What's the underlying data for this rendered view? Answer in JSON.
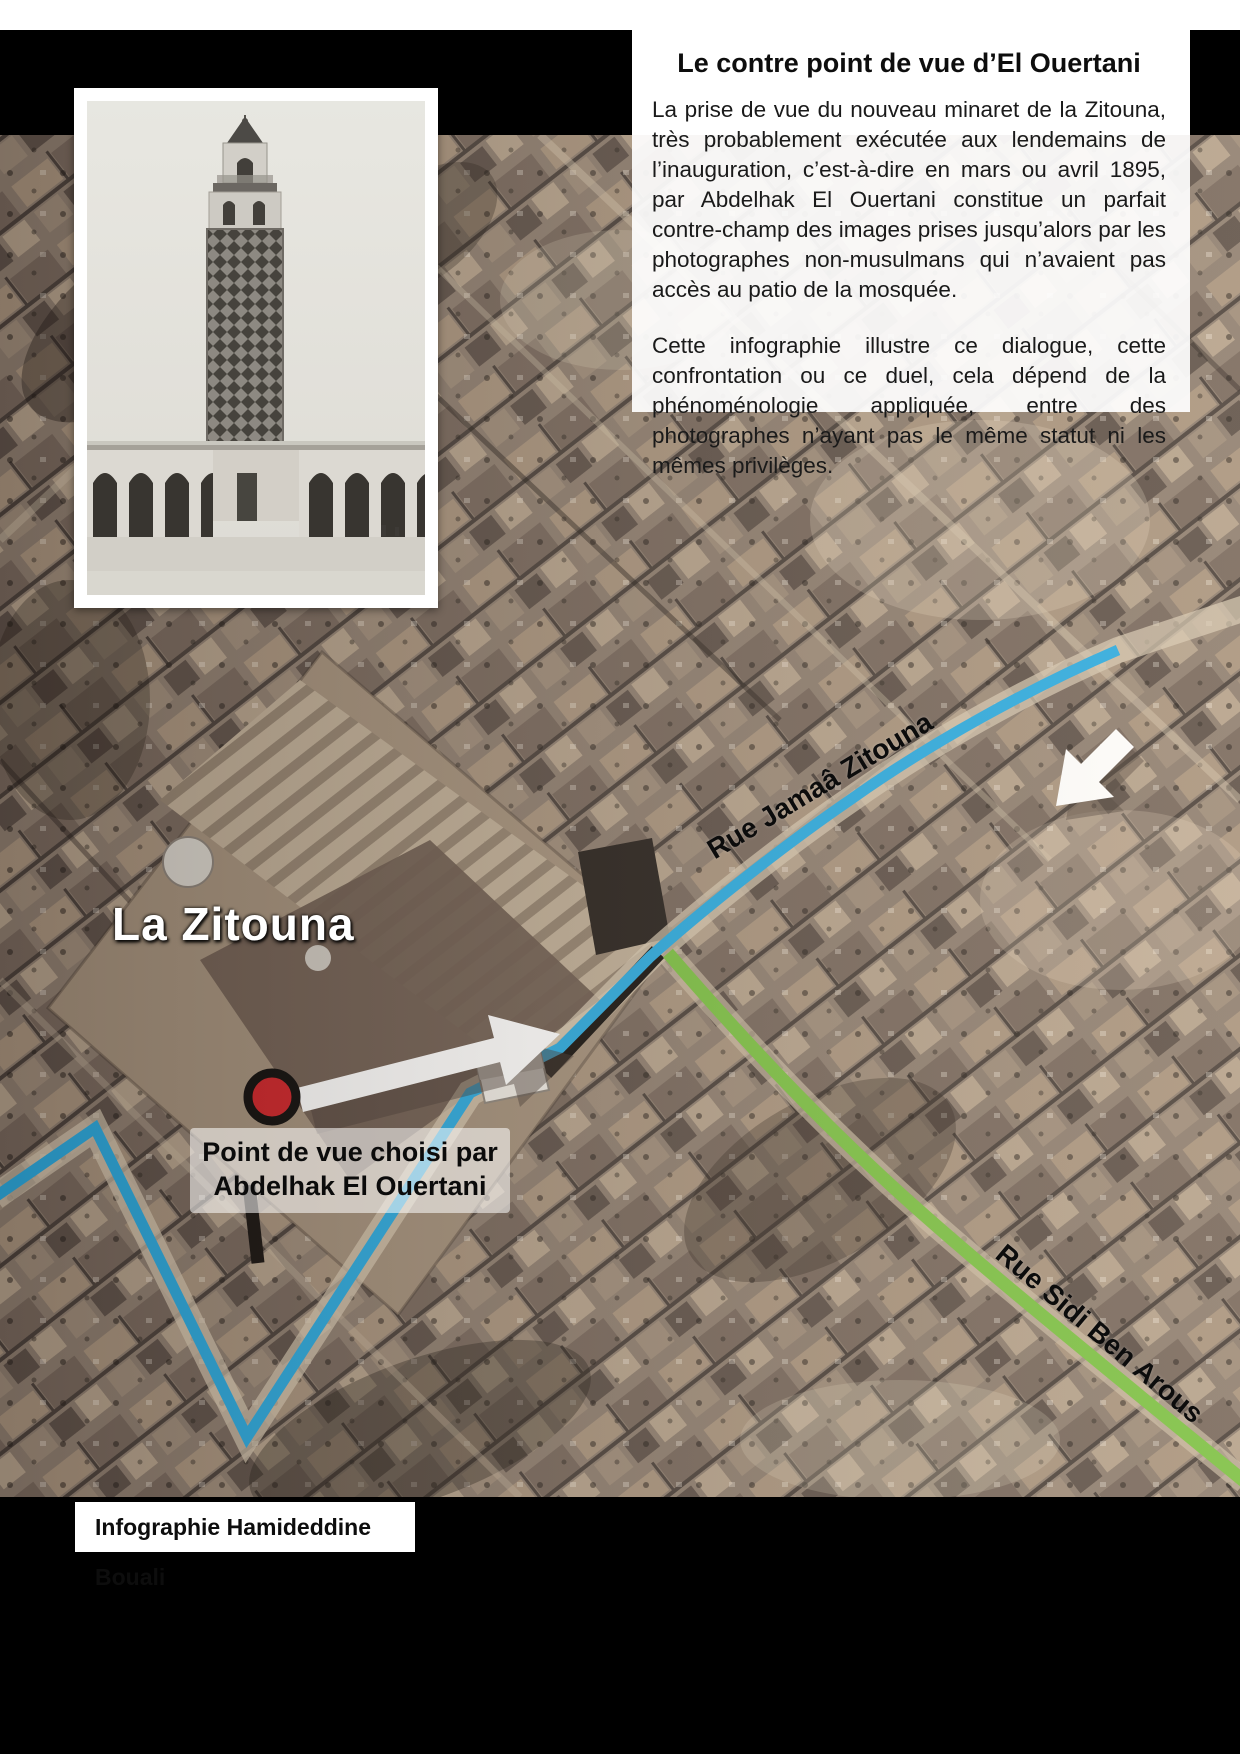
{
  "header_box": {
    "title": "Le contre point de vue d’El Ouertani",
    "paragraphs": [
      "La prise de vue du nouveau minaret de la Zitouna, très probablement exécutée aux lendemains de l’inauguration, c’est-à-dire en mars ou avril 1895, par Abdelhak El Ouertani constitue un parfait contre-champ des images prises jusqu’alors par les photographes non-musulmans qui n’avaient pas accès au patio de la mosquée.",
      "Cette infographie illustre ce dialogue, cette confrontation ou ce duel, cela dépend de la phénoménologie appliquée, entre des photographes n’ayant pas le même statut ni les mêmes privilèges."
    ]
  },
  "map": {
    "mosque_label": "La Zitouna",
    "street_blue_label": "Rue Jamaâ Zitouna",
    "street_green_label": "Rue Sidi Ben Arous",
    "marker_caption_line1": "Point de vue choisi par",
    "marker_caption_line2": "Abdelhak El Ouertani",
    "colors": {
      "route_blue": "#29abe2",
      "route_green": "#7bc143",
      "marker_red": "#cf2127",
      "street_label": "#0c0c0c",
      "mosque_label": "#ffffff"
    }
  },
  "footer": {
    "credit": "Infographie Hamideddine Bouali"
  }
}
